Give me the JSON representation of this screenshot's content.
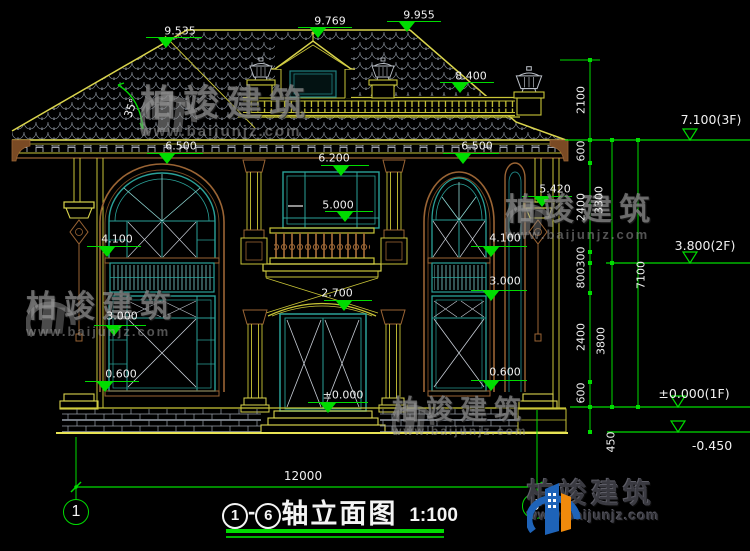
{
  "title": {
    "axis_from": "1",
    "dash": "-",
    "axis_to": "6",
    "name": "轴立面图",
    "scale": "1:100"
  },
  "axes": {
    "left_bubble": "1",
    "right_bubble": "6",
    "overall_width": "12000"
  },
  "brand": {
    "name": "柏竣建筑",
    "url": "www.baijunjz.com"
  },
  "annotations": [
    {
      "text": "9.535",
      "x": 180,
      "y": 31
    },
    {
      "text": "9.769",
      "x": 330,
      "y": 21
    },
    {
      "text": "9.955",
      "x": 419,
      "y": 15
    },
    {
      "text": "8.400",
      "x": 471,
      "y": 76
    },
    {
      "text": "6.500",
      "x": 181,
      "y": 146
    },
    {
      "text": "6.500",
      "x": 477,
      "y": 146
    },
    {
      "text": "6.200",
      "x": 334,
      "y": 158
    },
    {
      "text": "5.000",
      "x": 338,
      "y": 205
    },
    {
      "text": "5.420",
      "x": 555,
      "y": 189
    },
    {
      "text": "4.100",
      "x": 117,
      "y": 239
    },
    {
      "text": "4.100",
      "x": 505,
      "y": 238
    },
    {
      "text": "3.000",
      "x": 122,
      "y": 316
    },
    {
      "text": "3.000",
      "x": 505,
      "y": 281
    },
    {
      "text": "2.700",
      "x": 337,
      "y": 293
    },
    {
      "text": "0.600",
      "x": 121,
      "y": 374
    },
    {
      "text": "0.600",
      "x": 505,
      "y": 372
    },
    {
      "text": "±0.000",
      "x": 343,
      "y": 395
    },
    {
      "text": "35°",
      "x": 131,
      "y": 108,
      "rot": -70
    },
    {
      "text": "7.100(3F)",
      "x": 711,
      "y": 120,
      "size": 12.5
    },
    {
      "text": "3.800(2F)",
      "x": 705,
      "y": 246,
      "size": 12.5
    },
    {
      "text": "±0.000(1F)",
      "x": 694,
      "y": 394,
      "size": 12.5
    },
    {
      "text": "-0.450",
      "x": 712,
      "y": 446,
      "size": 12.5
    },
    {
      "text": "2100",
      "x": 581,
      "y": 100,
      "rot": -90
    },
    {
      "text": "600",
      "x": 581,
      "y": 151,
      "rot": -90
    },
    {
      "text": "2400",
      "x": 581,
      "y": 207,
      "rot": -90
    },
    {
      "text": "300",
      "x": 581,
      "y": 257,
      "rot": -90
    },
    {
      "text": "800",
      "x": 581,
      "y": 278,
      "rot": -90
    },
    {
      "text": "2400",
      "x": 581,
      "y": 337,
      "rot": -90
    },
    {
      "text": "600",
      "x": 581,
      "y": 393,
      "rot": -90
    },
    {
      "text": "450",
      "x": 611,
      "y": 442,
      "rot": -90
    },
    {
      "text": "3300",
      "x": 599,
      "y": 200,
      "rot": -90
    },
    {
      "text": "3800",
      "x": 601,
      "y": 341,
      "rot": -90
    },
    {
      "text": "7100",
      "x": 641,
      "y": 275,
      "rot": -90
    },
    {
      "text": "12000",
      "x": 303,
      "y": 476,
      "size": 12
    }
  ]
}
